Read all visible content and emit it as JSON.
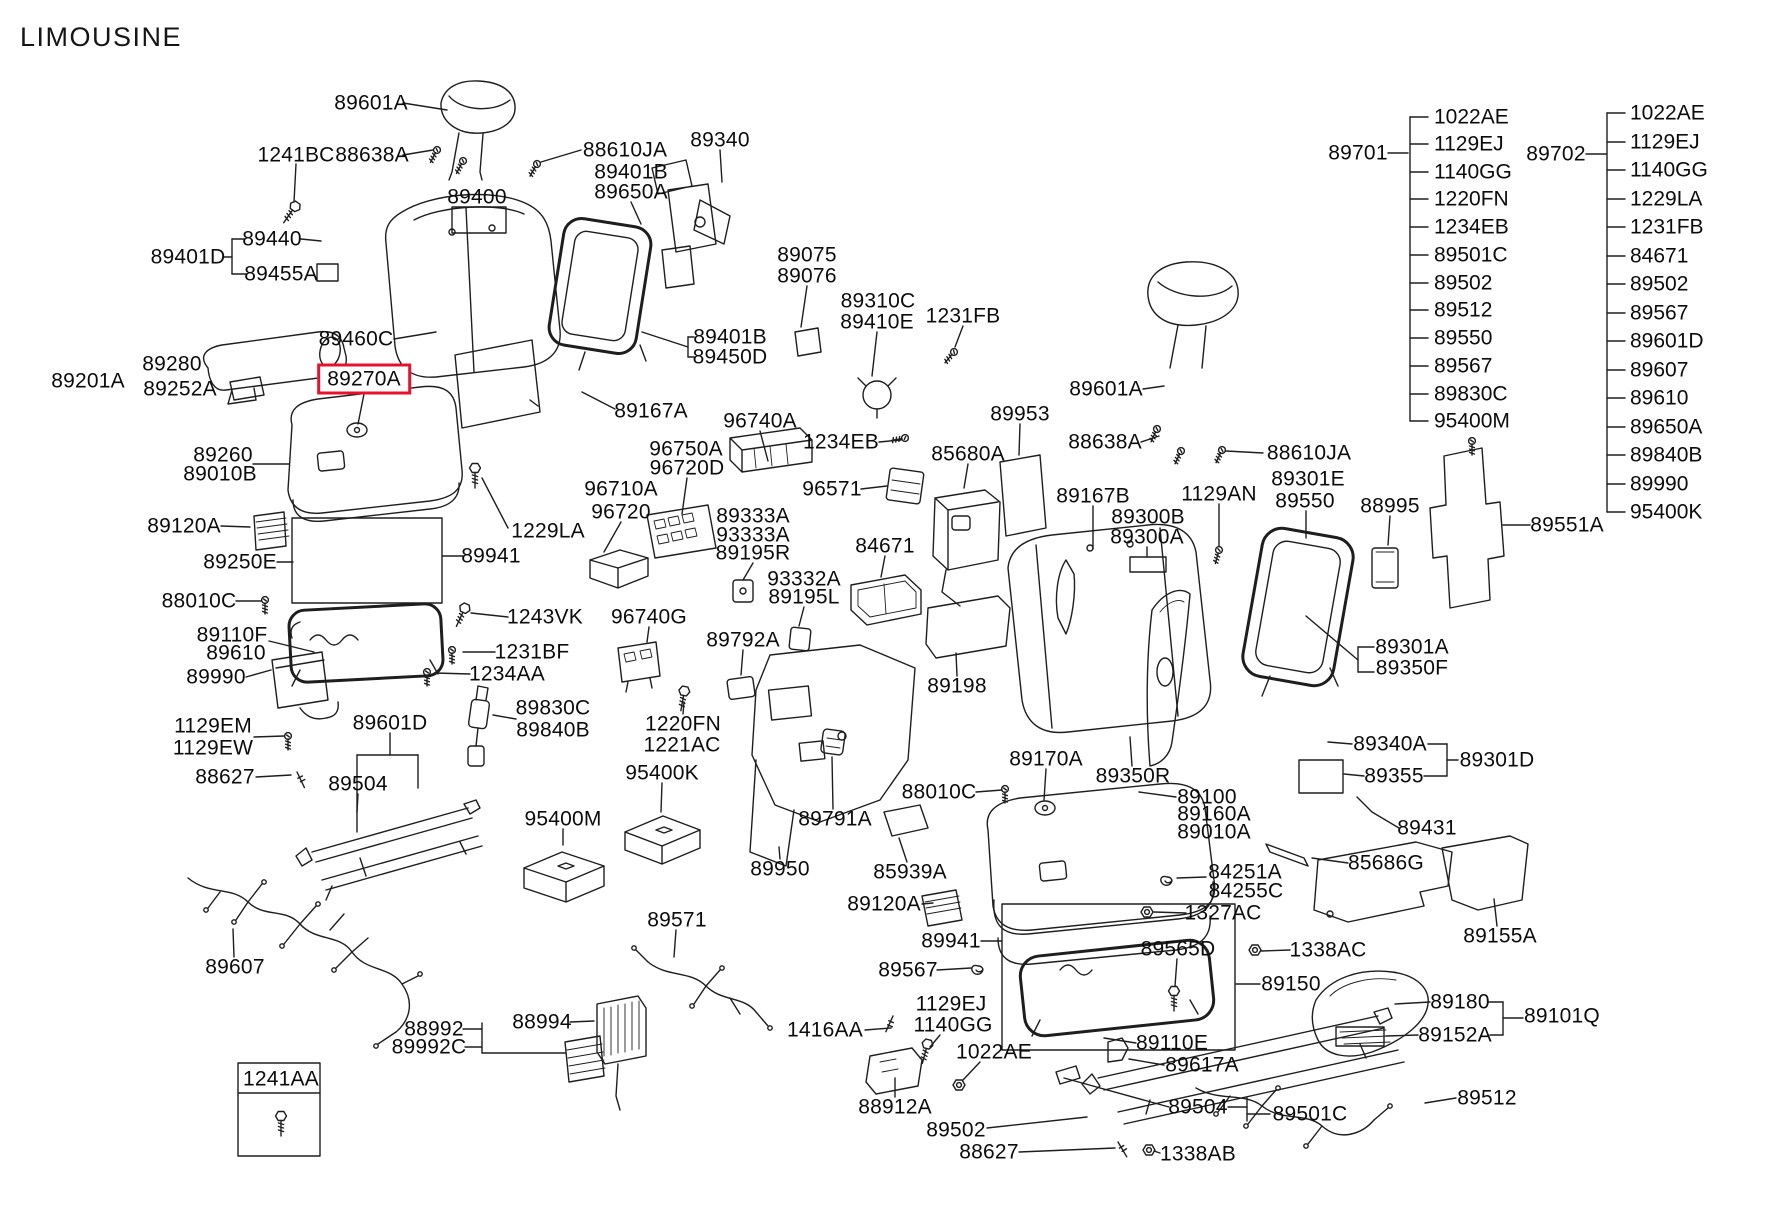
{
  "title": "LIMOUSINE",
  "colors": {
    "line": "#1e1e1e",
    "highlight": "#e8112d",
    "background": "#ffffff",
    "text": "#0c0c0c"
  },
  "highlighted_part": "89270A",
  "parts_lists": {
    "left": {
      "label": "89701",
      "label_x": 1358,
      "label_y": 153,
      "spine_x": 1410,
      "tick_len": 18,
      "items_x": 1434,
      "items": [
        {
          "t": "1022AE",
          "y": 117
        },
        {
          "t": "1129EJ",
          "y": 144
        },
        {
          "t": "1140GG",
          "y": 172
        },
        {
          "t": "1220FN",
          "y": 199
        },
        {
          "t": "1234EB",
          "y": 227
        },
        {
          "t": "89501C",
          "y": 255
        },
        {
          "t": "89502",
          "y": 283
        },
        {
          "t": "89512",
          "y": 310
        },
        {
          "t": "89550",
          "y": 338
        },
        {
          "t": "89567",
          "y": 366
        },
        {
          "t": "89830C",
          "y": 394
        },
        {
          "t": "95400M",
          "y": 421
        }
      ]
    },
    "right": {
      "label": "89702",
      "label_x": 1556,
      "label_y": 154,
      "spine_x": 1607,
      "tick_len": 18,
      "items_x": 1630,
      "items": [
        {
          "t": "1022AE",
          "y": 113
        },
        {
          "t": "1129EJ",
          "y": 142
        },
        {
          "t": "1140GG",
          "y": 170
        },
        {
          "t": "1229LA",
          "y": 199
        },
        {
          "t": "1231FB",
          "y": 227
        },
        {
          "t": "84671",
          "y": 256
        },
        {
          "t": "89502",
          "y": 284
        },
        {
          "t": "89567",
          "y": 313
        },
        {
          "t": "89601D",
          "y": 341
        },
        {
          "t": "89607",
          "y": 370
        },
        {
          "t": "89610",
          "y": 398
        },
        {
          "t": "89650A",
          "y": 427
        },
        {
          "t": "89840B",
          "y": 455
        },
        {
          "t": "89990",
          "y": 484
        },
        {
          "t": "95400K",
          "y": 512
        }
      ]
    }
  },
  "labels": [
    {
      "t": "89601A",
      "x": 371,
      "y": 103
    },
    {
      "t": "1241BC",
      "x": 296,
      "y": 155
    },
    {
      "t": "88638A",
      "x": 372,
      "y": 155
    },
    {
      "t": "88610JA",
      "x": 625,
      "y": 150
    },
    {
      "t": "89401B",
      "x": 631,
      "y": 172
    },
    {
      "t": "89650A",
      "x": 631,
      "y": 192
    },
    {
      "t": "89340",
      "x": 720,
      "y": 140
    },
    {
      "t": "89400",
      "x": 477,
      "y": 197
    },
    {
      "t": "89440",
      "x": 272,
      "y": 239
    },
    {
      "t": "89401D",
      "x": 188,
      "y": 257
    },
    {
      "t": "89455A",
      "x": 281,
      "y": 274
    },
    {
      "t": "89075",
      "x": 807,
      "y": 255
    },
    {
      "t": "89076",
      "x": 807,
      "y": 276
    },
    {
      "t": "89310C",
      "x": 878,
      "y": 301
    },
    {
      "t": "89410E",
      "x": 877,
      "y": 322
    },
    {
      "t": "1231FB",
      "x": 963,
      "y": 316
    },
    {
      "t": "89460C",
      "x": 356,
      "y": 339
    },
    {
      "t": "89401B",
      "n": 2,
      "x": 730,
      "y": 337
    },
    {
      "t": "89450D",
      "x": 730,
      "y": 357
    },
    {
      "t": "89280",
      "x": 172,
      "y": 364
    },
    {
      "t": "89201A",
      "x": 88,
      "y": 381
    },
    {
      "t": "89252A",
      "x": 180,
      "y": 389
    },
    {
      "t": "89270A",
      "x": 364,
      "y": 379,
      "hl": true
    },
    {
      "t": "89167A",
      "x": 651,
      "y": 411
    },
    {
      "t": "89260",
      "x": 223,
      "y": 455
    },
    {
      "t": "89010B",
      "x": 220,
      "y": 474
    },
    {
      "t": "96740A",
      "x": 760,
      "y": 421
    },
    {
      "t": "96750A",
      "x": 686,
      "y": 449
    },
    {
      "t": "96720D",
      "x": 687,
      "y": 468
    },
    {
      "t": "1234EB",
      "x": 841,
      "y": 442
    },
    {
      "t": "96571",
      "x": 832,
      "y": 489
    },
    {
      "t": "96710A",
      "x": 621,
      "y": 489
    },
    {
      "t": "96720",
      "x": 621,
      "y": 512
    },
    {
      "t": "89120A",
      "x": 184,
      "y": 526
    },
    {
      "t": "1229LA",
      "x": 548,
      "y": 531
    },
    {
      "t": "89333A",
      "x": 753,
      "y": 516
    },
    {
      "t": "93333A",
      "x": 753,
      "y": 535
    },
    {
      "t": "89195R",
      "x": 753,
      "y": 553
    },
    {
      "t": "84671",
      "x": 885,
      "y": 546
    },
    {
      "t": "89941",
      "x": 491,
      "y": 556
    },
    {
      "t": "89250E",
      "x": 240,
      "y": 562
    },
    {
      "t": "93332A",
      "x": 804,
      "y": 579
    },
    {
      "t": "89195L",
      "x": 804,
      "y": 597
    },
    {
      "t": "88010C",
      "x": 199,
      "y": 601
    },
    {
      "t": "1243VK",
      "x": 545,
      "y": 617
    },
    {
      "t": "96740G",
      "x": 649,
      "y": 617
    },
    {
      "t": "89792A",
      "x": 743,
      "y": 640
    },
    {
      "t": "89110F",
      "x": 232,
      "y": 635
    },
    {
      "t": "89610",
      "x": 236,
      "y": 653
    },
    {
      "t": "1231BF",
      "x": 532,
      "y": 652
    },
    {
      "t": "89990",
      "x": 216,
      "y": 677
    },
    {
      "t": "1234AA",
      "x": 507,
      "y": 674
    },
    {
      "t": "89198",
      "x": 957,
      "y": 686
    },
    {
      "t": "89301A",
      "x": 1412,
      "y": 647
    },
    {
      "t": "89350F",
      "x": 1412,
      "y": 668
    },
    {
      "t": "1129EM",
      "x": 213,
      "y": 726
    },
    {
      "t": "1129EW",
      "x": 213,
      "y": 748
    },
    {
      "t": "89830C",
      "x": 553,
      "y": 708
    },
    {
      "t": "89840B",
      "x": 553,
      "y": 730
    },
    {
      "t": "89601D",
      "x": 390,
      "y": 723
    },
    {
      "t": "1220FN",
      "x": 683,
      "y": 724
    },
    {
      "t": "1221AC",
      "x": 682,
      "y": 745
    },
    {
      "t": "88627",
      "x": 225,
      "y": 777
    },
    {
      "t": "89504",
      "x": 358,
      "y": 784
    },
    {
      "t": "95400K",
      "x": 662,
      "y": 773
    },
    {
      "t": "89340A",
      "x": 1390,
      "y": 744
    },
    {
      "t": "89355",
      "x": 1394,
      "y": 776
    },
    {
      "t": "89301D",
      "x": 1497,
      "y": 760
    },
    {
      "t": "89170A",
      "x": 1046,
      "y": 759
    },
    {
      "t": "89350R",
      "x": 1133,
      "y": 776
    },
    {
      "t": "88010C",
      "n": 2,
      "x": 939,
      "y": 792
    },
    {
      "t": "89100",
      "x": 1207,
      "y": 797
    },
    {
      "t": "89160A",
      "x": 1214,
      "y": 814
    },
    {
      "t": "89010A",
      "x": 1214,
      "y": 832
    },
    {
      "t": "95400M",
      "x": 563,
      "y": 819
    },
    {
      "t": "89431",
      "x": 1427,
      "y": 828
    },
    {
      "t": "89791A",
      "x": 835,
      "y": 819
    },
    {
      "t": "85686G",
      "x": 1386,
      "y": 863
    },
    {
      "t": "84251A",
      "x": 1245,
      "y": 872
    },
    {
      "t": "84255C",
      "x": 1246,
      "y": 891
    },
    {
      "t": "89950",
      "x": 780,
      "y": 869
    },
    {
      "t": "85939A",
      "x": 910,
      "y": 872
    },
    {
      "t": "1327AC",
      "x": 1223,
      "y": 913
    },
    {
      "t": "89155A",
      "x": 1500,
      "y": 936
    },
    {
      "t": "89120A",
      "n": 2,
      "x": 884,
      "y": 904
    },
    {
      "t": "89941",
      "n": 2,
      "x": 951,
      "y": 941
    },
    {
      "t": "89565D",
      "x": 1178,
      "y": 949
    },
    {
      "t": "1338AC",
      "x": 1328,
      "y": 950
    },
    {
      "t": "89567",
      "x": 908,
      "y": 970
    },
    {
      "t": "89150",
      "x": 1291,
      "y": 984
    },
    {
      "t": "89571",
      "x": 677,
      "y": 920
    },
    {
      "t": "89607",
      "x": 235,
      "y": 967
    },
    {
      "t": "1129EJ",
      "x": 951,
      "y": 1004
    },
    {
      "t": "1140GG",
      "x": 953,
      "y": 1025
    },
    {
      "t": "1416AA",
      "x": 825,
      "y": 1030
    },
    {
      "t": "1022AE",
      "x": 994,
      "y": 1052
    },
    {
      "t": "88992",
      "x": 434,
      "y": 1029
    },
    {
      "t": "89992C",
      "x": 429,
      "y": 1047
    },
    {
      "t": "88994",
      "x": 542,
      "y": 1022
    },
    {
      "t": "89180",
      "x": 1460,
      "y": 1002
    },
    {
      "t": "89101Q",
      "x": 1562,
      "y": 1016
    },
    {
      "t": "89152A",
      "x": 1455,
      "y": 1035
    },
    {
      "t": "89110E",
      "x": 1172,
      "y": 1043
    },
    {
      "t": "89617A",
      "x": 1202,
      "y": 1065
    },
    {
      "t": "88912A",
      "x": 895,
      "y": 1107
    },
    {
      "t": "89504",
      "n": 2,
      "x": 1198,
      "y": 1107
    },
    {
      "t": "89501C",
      "x": 1310,
      "y": 1114
    },
    {
      "t": "89512",
      "x": 1487,
      "y": 1098
    },
    {
      "t": "89502",
      "x": 956,
      "y": 1130
    },
    {
      "t": "88627",
      "n": 2,
      "x": 989,
      "y": 1152
    },
    {
      "t": "1338AB",
      "x": 1198,
      "y": 1154
    },
    {
      "t": "1241AA",
      "x": 281,
      "y": 1079
    },
    {
      "t": "89953",
      "x": 1020,
      "y": 414
    },
    {
      "t": "85680A",
      "x": 968,
      "y": 454
    },
    {
      "t": "89167B",
      "x": 1093,
      "y": 496
    },
    {
      "t": "89300B",
      "x": 1148,
      "y": 517
    },
    {
      "t": "89300A",
      "x": 1147,
      "y": 537
    },
    {
      "t": "1129AN",
      "x": 1219,
      "y": 494
    },
    {
      "t": "88610JA",
      "n": 2,
      "x": 1309,
      "y": 453
    },
    {
      "t": "89301E",
      "x": 1308,
      "y": 479
    },
    {
      "t": "89550",
      "x": 1305,
      "y": 501
    },
    {
      "t": "88995",
      "x": 1390,
      "y": 506
    },
    {
      "t": "89551A",
      "x": 1567,
      "y": 525
    },
    {
      "t": "89601A",
      "n": 2,
      "x": 1106,
      "y": 389
    },
    {
      "t": "88638A",
      "n": 2,
      "x": 1105,
      "y": 442
    }
  ],
  "leaders": [
    [
      403,
      103,
      447,
      110
    ],
    [
      296,
      164,
      294,
      202
    ],
    [
      403,
      155,
      433,
      150
    ],
    [
      581,
      150,
      541,
      162
    ],
    [
      631,
      202,
      641,
      224
    ],
    [
      720,
      150,
      722,
      182
    ],
    [
      301,
      239,
      321,
      241
    ],
    [
      224,
      257,
      232,
      257
    ],
    [
      232,
      239,
      232,
      274
    ],
    [
      232,
      239,
      244,
      239
    ],
    [
      232,
      274,
      246,
      274
    ],
    [
      807,
      286,
      801,
      327
    ],
    [
      877,
      332,
      872,
      376
    ],
    [
      963,
      326,
      955,
      347
    ],
    [
      694,
      337,
      688,
      337
    ],
    [
      694,
      357,
      688,
      357
    ],
    [
      688,
      337,
      688,
      357
    ],
    [
      688,
      347,
      642,
      332
    ],
    [
      394,
      339,
      436,
      332
    ],
    [
      364,
      394,
      358,
      424
    ],
    [
      253,
      464,
      289,
      464
    ],
    [
      615,
      409,
      582,
      392
    ],
    [
      760,
      431,
      768,
      461
    ],
    [
      879,
      442,
      901,
      440
    ],
    [
      687,
      478,
      682,
      514
    ],
    [
      861,
      489,
      887,
      486
    ],
    [
      621,
      522,
      604,
      552
    ],
    [
      753,
      563,
      743,
      580
    ],
    [
      804,
      607,
      799,
      626
    ],
    [
      885,
      556,
      881,
      577
    ],
    [
      508,
      528,
      482,
      478
    ],
    [
      463,
      556,
      443,
      556
    ],
    [
      277,
      562,
      293,
      562
    ],
    [
      236,
      601,
      261,
      601
    ],
    [
      508,
      617,
      471,
      613
    ],
    [
      269,
      641,
      314,
      652
    ],
    [
      246,
      677,
      271,
      670
    ],
    [
      495,
      652,
      463,
      652
    ],
    [
      470,
      674,
      435,
      673
    ],
    [
      516,
      719,
      493,
      715
    ],
    [
      254,
      737,
      284,
      736
    ],
    [
      256,
      777,
      291,
      775
    ],
    [
      390,
      733,
      390,
      755
    ],
    [
      357,
      755,
      418,
      755
    ],
    [
      357,
      755,
      357,
      832
    ],
    [
      418,
      755,
      418,
      788
    ],
    [
      358,
      794,
      357,
      812
    ],
    [
      563,
      829,
      563,
      845
    ],
    [
      662,
      783,
      661,
      812
    ],
    [
      683,
      714,
      684,
      702
    ],
    [
      649,
      627,
      647,
      642
    ],
    [
      743,
      650,
      741,
      675
    ],
    [
      1093,
      506,
      1093,
      549
    ],
    [
      1147,
      547,
      1147,
      557
    ],
    [
      1219,
      504,
      1219,
      546
    ],
    [
      1263,
      453,
      1226,
      451
    ],
    [
      1143,
      389,
      1164,
      386
    ],
    [
      1141,
      442,
      1159,
      436
    ],
    [
      1020,
      424,
      1019,
      455
    ],
    [
      968,
      464,
      964,
      488
    ],
    [
      1530,
      525,
      1503,
      525
    ],
    [
      1390,
      516,
      1388,
      545
    ],
    [
      1306,
      511,
      1306,
      538
    ],
    [
      1374,
      647,
      1358,
      647
    ],
    [
      1358,
      647,
      1358,
      672
    ],
    [
      1358,
      672,
      1374,
      672
    ],
    [
      1358,
      660,
      1306,
      616
    ],
    [
      1428,
      744,
      1447,
      744
    ],
    [
      1424,
      776,
      1447,
      776
    ],
    [
      1447,
      744,
      1447,
      776
    ],
    [
      1447,
      760,
      1458,
      760
    ],
    [
      1352,
      744,
      1328,
      742
    ],
    [
      1364,
      776,
      1344,
      774
    ],
    [
      1399,
      828,
      1372,
      812,
      1357,
      797
    ],
    [
      1046,
      769,
      1044,
      800
    ],
    [
      1132,
      766,
      1130,
      737
    ],
    [
      1176,
      797,
      1139,
      792
    ],
    [
      1348,
      863,
      1312,
      858
    ],
    [
      1206,
      877,
      1177,
      878
    ],
    [
      1186,
      913,
      1154,
      912
    ],
    [
      1177,
      959,
      1175,
      986
    ],
    [
      1290,
      950,
      1261,
      951
    ],
    [
      1260,
      984,
      1236,
      984
    ],
    [
      1497,
      926,
      1494,
      899
    ],
    [
      1489,
      1002,
      1503,
      1002
    ],
    [
      1503,
      1002,
      1503,
      1035
    ],
    [
      1490,
      1035,
      1503,
      1035
    ],
    [
      1503,
      1018,
      1523,
      1018
    ],
    [
      1430,
      1002,
      1395,
      1004
    ],
    [
      1418,
      1035,
      1386,
      1036
    ],
    [
      1456,
      1098,
      1425,
      1103
    ],
    [
      1136,
      1043,
      1104,
      1038
    ],
    [
      1164,
      1065,
      1129,
      1059
    ],
    [
      1169,
      1107,
      1064,
      1078
    ],
    [
      1228,
      1107,
      1247,
      1107
    ],
    [
      1247,
      1098,
      1247,
      1121
    ],
    [
      1247,
      1114,
      1270,
      1114
    ],
    [
      1160,
      1153,
      1154,
      1151
    ],
    [
      1019,
      1152,
      1115,
      1148
    ],
    [
      987,
      1128,
      1087,
      1117
    ],
    [
      895,
      1097,
      895,
      1078
    ],
    [
      980,
      1062,
      963,
      1080
    ],
    [
      940,
      1035,
      930,
      1047
    ],
    [
      865,
      1030,
      891,
      1028
    ],
    [
      937,
      970,
      971,
      968
    ],
    [
      981,
      941,
      1002,
      941
    ],
    [
      780,
      859,
      779,
      847
    ],
    [
      907,
      862,
      899,
      838
    ],
    [
      922,
      904,
      933,
      903
    ],
    [
      833,
      809,
      832,
      757
    ],
    [
      976,
      792,
      1002,
      790
    ],
    [
      957,
      676,
      956,
      653
    ],
    [
      676,
      930,
      674,
      957
    ],
    [
      463,
      1029,
      482,
      1029
    ],
    [
      482,
      1023,
      482,
      1053
    ],
    [
      465,
      1047,
      482,
      1047
    ],
    [
      482,
      1053,
      565,
      1053
    ],
    [
      570,
      1022,
      594,
      1021
    ],
    [
      234,
      957,
      233,
      929
    ],
    [
      1388,
      153,
      1408,
      153
    ],
    [
      1586,
      154,
      1606,
      154
    ],
    [
      221,
      526,
      250,
      527
    ],
    [
      238,
      1093,
      320,
      1093
    ]
  ],
  "boxes": [
    [
      452,
      207,
      54,
      26
    ],
    [
      292,
      518,
      150,
      85
    ],
    [
      1002,
      904,
      233,
      146
    ],
    [
      238,
      1063,
      82,
      93
    ],
    [
      1130,
      557,
      36,
      15
    ],
    [
      317,
      264,
      21,
      17
    ],
    [
      1299,
      760,
      44,
      33
    ],
    [
      1336,
      1027,
      48,
      19
    ]
  ]
}
